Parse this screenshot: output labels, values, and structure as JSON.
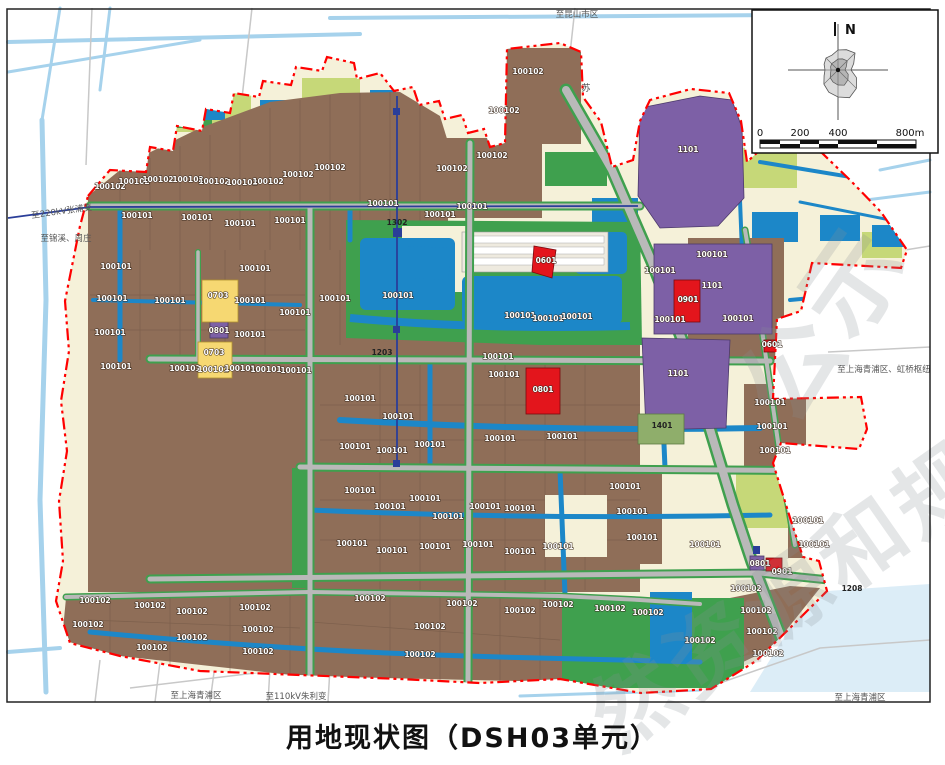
{
  "title": "用地现状图（DSH03单元）",
  "compass": {
    "north_label": "N"
  },
  "scalebar": {
    "ticks": [
      {
        "label": "0",
        "x": 760
      },
      {
        "label": "200",
        "x": 800
      },
      {
        "label": "400",
        "x": 838
      },
      {
        "label": "800m",
        "x": 910
      }
    ]
  },
  "peripheral_labels": [
    {
      "text": "至昆山市区",
      "x": 577,
      "y": 17,
      "rot": 0
    },
    {
      "text": "至220kV张浦变",
      "x": 62,
      "y": 214,
      "rot": -8
    },
    {
      "text": "至锦溪、周庄",
      "x": 66,
      "y": 241,
      "rot": 0
    },
    {
      "text": "至上海青浦区、虹桥枢纽",
      "x": 884,
      "y": 372,
      "rot": 0
    },
    {
      "text": "至上海青浦区",
      "x": 196,
      "y": 698,
      "rot": 0
    },
    {
      "text": "至110kV朱利变",
      "x": 296,
      "y": 699,
      "rot": 0
    },
    {
      "text": "至上海青浦区",
      "x": 860,
      "y": 700,
      "rot": 0
    }
  ],
  "road_labels": [
    {
      "text": "苏",
      "x": 586,
      "y": 91
    }
  ],
  "watermarks": [
    {
      "text": "公示",
      "x": 792,
      "y": 430,
      "size": 100,
      "rot": -55
    },
    {
      "text": "然资源和规划",
      "x": 618,
      "y": 752,
      "size": 86,
      "rot": -35
    }
  ],
  "colors": {
    "parcel_brown": "#8f6e58",
    "farm_cream": "#f5f1d9",
    "green": "#3fa04e",
    "lime": "#c6d878",
    "water": "#1c87c8",
    "light_water": "#a6d2ec",
    "purple": "#7d60a6",
    "red": "#e3151c",
    "yellow": "#f6d872",
    "road_gray": "#b9b9b9",
    "boundary_red": "#ff0000",
    "powerline_blue": "#2a3e99"
  },
  "parcel_labels": [
    {
      "c": "100102",
      "x": 110,
      "y": 189
    },
    {
      "c": "100102",
      "x": 134,
      "y": 184
    },
    {
      "c": "100102",
      "x": 158,
      "y": 182
    },
    {
      "c": "100102",
      "x": 188,
      "y": 182
    },
    {
      "c": "100102",
      "x": 214,
      "y": 184
    },
    {
      "c": "100102",
      "x": 242,
      "y": 185
    },
    {
      "c": "100102",
      "x": 268,
      "y": 184
    },
    {
      "c": "100102",
      "x": 298,
      "y": 177
    },
    {
      "c": "100102",
      "x": 330,
      "y": 170
    },
    {
      "c": "100102",
      "x": 452,
      "y": 171
    },
    {
      "c": "100102",
      "x": 492,
      "y": 158
    },
    {
      "c": "100102",
      "x": 528,
      "y": 74
    },
    {
      "c": "100102",
      "x": 504,
      "y": 113
    },
    {
      "c": "100101",
      "x": 137,
      "y": 218
    },
    {
      "c": "100101",
      "x": 197,
      "y": 220
    },
    {
      "c": "100101",
      "x": 240,
      "y": 226
    },
    {
      "c": "100101",
      "x": 290,
      "y": 223
    },
    {
      "c": "100101",
      "x": 383,
      "y": 206
    },
    {
      "c": "100101",
      "x": 440,
      "y": 217
    },
    {
      "c": "100101",
      "x": 472,
      "y": 209
    },
    {
      "c": "100101",
      "x": 116,
      "y": 269
    },
    {
      "c": "100101",
      "x": 112,
      "y": 301
    },
    {
      "c": "100101",
      "x": 110,
      "y": 335
    },
    {
      "c": "100101",
      "x": 116,
      "y": 369
    },
    {
      "c": "100101",
      "x": 170,
      "y": 303
    },
    {
      "c": "100101",
      "x": 255,
      "y": 271
    },
    {
      "c": "100101",
      "x": 250,
      "y": 303
    },
    {
      "c": "100101",
      "x": 250,
      "y": 337
    },
    {
      "c": "100101",
      "x": 295,
      "y": 315
    },
    {
      "c": "100101",
      "x": 335,
      "y": 301
    },
    {
      "c": "100101",
      "x": 398,
      "y": 298
    },
    {
      "c": "100101",
      "x": 520,
      "y": 318
    },
    {
      "c": "100101",
      "x": 548,
      "y": 321
    },
    {
      "c": "100101",
      "x": 577,
      "y": 319
    },
    {
      "c": "100101",
      "x": 660,
      "y": 273
    },
    {
      "c": "100101",
      "x": 670,
      "y": 322
    },
    {
      "c": "100101",
      "x": 712,
      "y": 257
    },
    {
      "c": "100101",
      "x": 738,
      "y": 321
    },
    {
      "c": "100101",
      "x": 185,
      "y": 371
    },
    {
      "c": "100101",
      "x": 213,
      "y": 372
    },
    {
      "c": "100101",
      "x": 240,
      "y": 371
    },
    {
      "c": "100101",
      "x": 266,
      "y": 372
    },
    {
      "c": "100101",
      "x": 296,
      "y": 373
    },
    {
      "c": "100101",
      "x": 360,
      "y": 401
    },
    {
      "c": "100101",
      "x": 398,
      "y": 419
    },
    {
      "c": "100101",
      "x": 498,
      "y": 359
    },
    {
      "c": "100101",
      "x": 504,
      "y": 377
    },
    {
      "c": "100101",
      "x": 500,
      "y": 441
    },
    {
      "c": "100101",
      "x": 562,
      "y": 439
    },
    {
      "c": "100101",
      "x": 355,
      "y": 449
    },
    {
      "c": "100101",
      "x": 392,
      "y": 453
    },
    {
      "c": "100101",
      "x": 430,
      "y": 447
    },
    {
      "c": "100101",
      "x": 360,
      "y": 493
    },
    {
      "c": "100101",
      "x": 390,
      "y": 509
    },
    {
      "c": "100101",
      "x": 425,
      "y": 501
    },
    {
      "c": "100101",
      "x": 448,
      "y": 519
    },
    {
      "c": "100101",
      "x": 485,
      "y": 509
    },
    {
      "c": "100101",
      "x": 520,
      "y": 511
    },
    {
      "c": "100101",
      "x": 352,
      "y": 546
    },
    {
      "c": "100101",
      "x": 392,
      "y": 553
    },
    {
      "c": "100101",
      "x": 435,
      "y": 549
    },
    {
      "c": "100101",
      "x": 478,
      "y": 547
    },
    {
      "c": "100101",
      "x": 520,
      "y": 554
    },
    {
      "c": "100101",
      "x": 558,
      "y": 549
    },
    {
      "c": "100101",
      "x": 625,
      "y": 489
    },
    {
      "c": "100101",
      "x": 632,
      "y": 514
    },
    {
      "c": "100101",
      "x": 642,
      "y": 540
    },
    {
      "c": "100101",
      "x": 770,
      "y": 405
    },
    {
      "c": "100101",
      "x": 772,
      "y": 429
    },
    {
      "c": "100101",
      "x": 775,
      "y": 453
    },
    {
      "c": "100101",
      "x": 808,
      "y": 523
    },
    {
      "c": "100101",
      "x": 814,
      "y": 547
    },
    {
      "c": "100101",
      "x": 705,
      "y": 547
    },
    {
      "c": "100102",
      "x": 95,
      "y": 603
    },
    {
      "c": "100102",
      "x": 88,
      "y": 627
    },
    {
      "c": "100102",
      "x": 150,
      "y": 608
    },
    {
      "c": "100102",
      "x": 152,
      "y": 650
    },
    {
      "c": "100102",
      "x": 192,
      "y": 614
    },
    {
      "c": "100102",
      "x": 192,
      "y": 640
    },
    {
      "c": "100102",
      "x": 255,
      "y": 610
    },
    {
      "c": "100102",
      "x": 258,
      "y": 632
    },
    {
      "c": "100102",
      "x": 258,
      "y": 654
    },
    {
      "c": "100102",
      "x": 370,
      "y": 601
    },
    {
      "c": "100102",
      "x": 430,
      "y": 629
    },
    {
      "c": "100102",
      "x": 420,
      "y": 657
    },
    {
      "c": "100102",
      "x": 462,
      "y": 606
    },
    {
      "c": "100102",
      "x": 520,
      "y": 613
    },
    {
      "c": "100102",
      "x": 558,
      "y": 607
    },
    {
      "c": "100102",
      "x": 610,
      "y": 611
    },
    {
      "c": "100102",
      "x": 648,
      "y": 615
    },
    {
      "c": "100102",
      "x": 746,
      "y": 591
    },
    {
      "c": "100102",
      "x": 756,
      "y": 613
    },
    {
      "c": "100102",
      "x": 762,
      "y": 634
    },
    {
      "c": "100102",
      "x": 768,
      "y": 656
    },
    {
      "c": "100102",
      "x": 700,
      "y": 643
    },
    {
      "c": "0703",
      "x": 218,
      "y": 298
    },
    {
      "c": "0801",
      "x": 219,
      "y": 333
    },
    {
      "c": "0703",
      "x": 214,
      "y": 355
    },
    {
      "c": "0801",
      "x": 543,
      "y": 392
    },
    {
      "c": "0901",
      "x": 688,
      "y": 302
    },
    {
      "c": "0601",
      "x": 546,
      "y": 263
    },
    {
      "c": "1101",
      "x": 688,
      "y": 152
    },
    {
      "c": "1101",
      "x": 712,
      "y": 288
    },
    {
      "c": "1101",
      "x": 678,
      "y": 376
    },
    {
      "c": "1302",
      "x": 397,
      "y": 225,
      "dark": true
    },
    {
      "c": "1203",
      "x": 382,
      "y": 355,
      "dark": true
    },
    {
      "c": "1401",
      "x": 662,
      "y": 428,
      "dark": true
    },
    {
      "c": "1208",
      "x": 852,
      "y": 591,
      "dark": true
    },
    {
      "c": "0801",
      "x": 760,
      "y": 566
    },
    {
      "c": "0901",
      "x": 782,
      "y": 574
    },
    {
      "c": "0601",
      "x": 772,
      "y": 347
    }
  ]
}
